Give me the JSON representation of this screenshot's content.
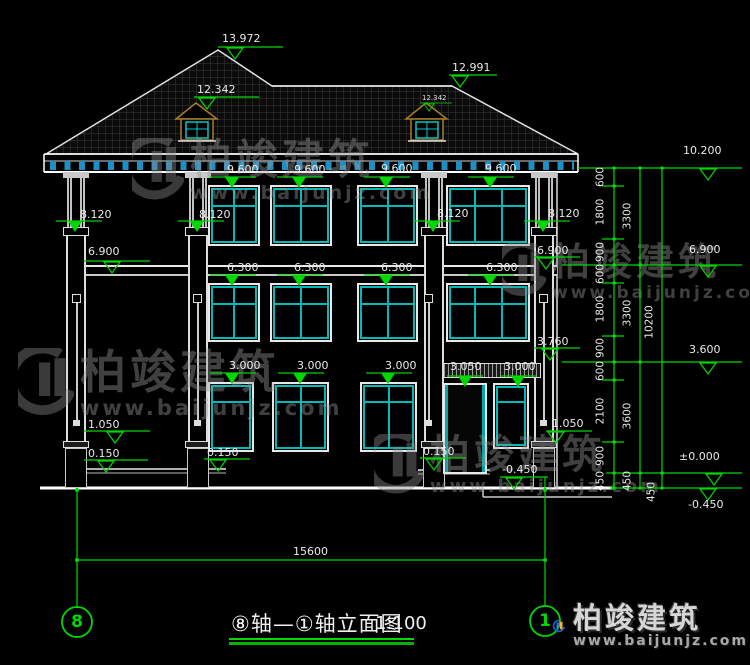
{
  "watermark": {
    "brand": "柏竣建筑",
    "url": "www.baijunjz.com"
  },
  "logo": {
    "brand": "柏竣建筑",
    "url": "www.baijunjz.com"
  },
  "title": {
    "name": "⑧轴—①轴立面图",
    "scale": "1:100"
  },
  "axis_bubbles": {
    "left": "8",
    "right": "1"
  },
  "dim_total_width": "15600",
  "elev": {
    "peak_left": "13.972",
    "dormer_left": "12.342",
    "peak_right": "12.991",
    "dormer_right": "12.342",
    "right_stack": [
      "10.200",
      "6.900",
      "3.600",
      "±0.000",
      "-0.450"
    ],
    "left_stack": [
      "6.900",
      "1.050",
      "0.150"
    ],
    "col_caps": [
      "8.120",
      "8.120",
      "8.120",
      "8.120"
    ],
    "floor3": [
      "9.600",
      "9.600",
      "9.600",
      "9.600"
    ],
    "floor2": [
      "6.300",
      "6.300",
      "6.300",
      "6.300"
    ],
    "floor1": [
      "3.000",
      "3.000",
      "3.000"
    ],
    "lintel": [
      "3.050",
      "3.000"
    ],
    "misc": {
      "porch_floor_b": "0.150",
      "porch_floor_c": "0.150",
      "right_rail": "1.050",
      "right_mid": "3.760",
      "right_wall": "6.900",
      "ground_right": "-0.450"
    }
  },
  "chains": {
    "inner": [
      "600",
      "1800",
      "900",
      "600",
      "1800",
      "900",
      "600",
      "2100",
      "900",
      "450"
    ],
    "middle": [
      "3300",
      "3300",
      "3600",
      "450"
    ],
    "outer": [
      "10200",
      "450"
    ]
  }
}
